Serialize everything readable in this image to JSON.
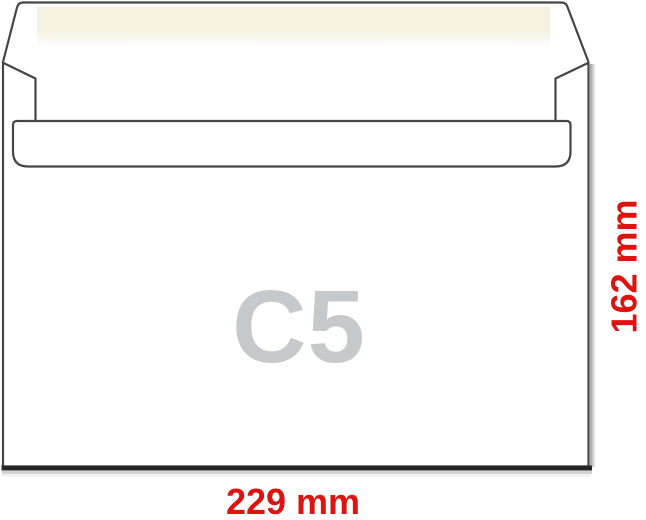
{
  "diagram": {
    "size_label": "C5",
    "width_dimension": "229 mm",
    "height_dimension": "162 mm",
    "colors": {
      "dimension_text": "#dd1310",
      "size_text": "#c6c9cb",
      "outline": "#454545",
      "adhesive_strip": "#f6f2e2",
      "paper": "#ffffff",
      "bottom_shadow": "#262626",
      "side_shadow": "#909090"
    }
  }
}
